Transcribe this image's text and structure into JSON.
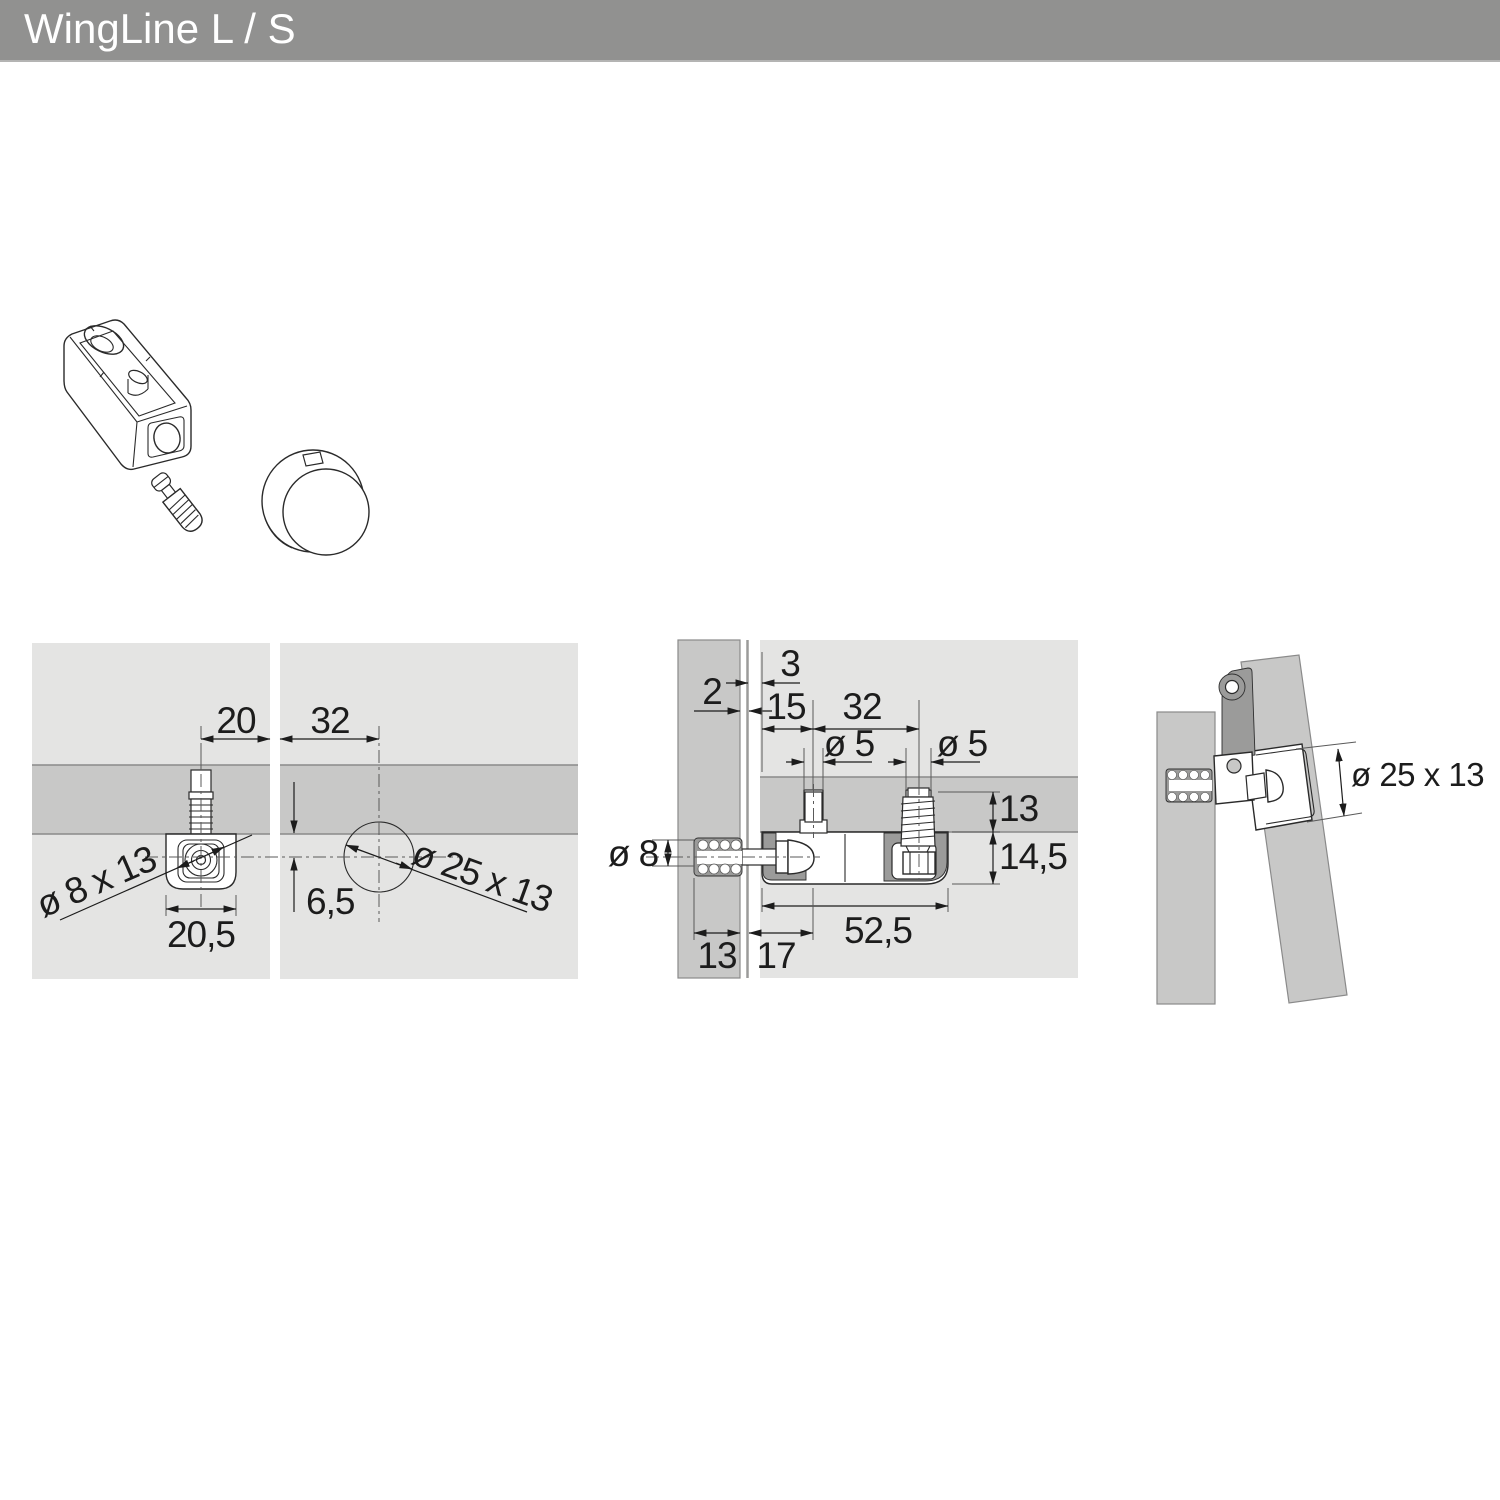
{
  "header": {
    "title": "WingLine L / S"
  },
  "colors": {
    "header_bar": "#919190",
    "panel_light": "#e4e4e3",
    "panel_mid": "#c8c8c7",
    "section_dark": "#9b9b9a",
    "line": "#2a2a2a",
    "dim_line": "#1c1c1c"
  },
  "front_view": {
    "labels": {
      "w20": "20",
      "w32": "32",
      "h65": "6,5",
      "w205": "20,5",
      "dia8x13": "ø 8 x 13",
      "dia25x13": "ø 25 x 13"
    }
  },
  "section_view": {
    "labels": {
      "g3": "3",
      "g2": "2",
      "w15": "15",
      "w32": "32",
      "dia5_left": "ø 5",
      "dia5_right": "ø 5",
      "depth13": "13",
      "h145": "14,5",
      "dia8": "ø 8",
      "w525": "52,5",
      "d13": "13",
      "d17": "17"
    }
  },
  "side_view": {
    "labels": {
      "dia25x13": "ø 25 x 13"
    }
  }
}
